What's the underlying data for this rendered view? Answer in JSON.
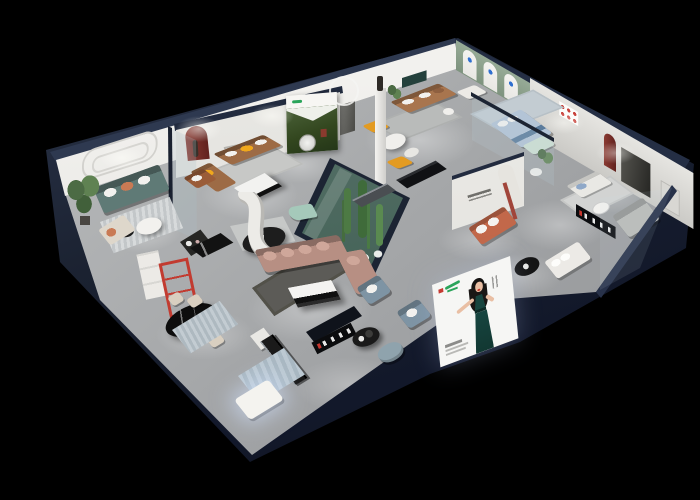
{
  "scene": {
    "type": "isometric-cutaway-floorplan-render",
    "description": "Isometric cutaway 3D rendering of a furniture showroom floor plan on a black background. Dark navy perimeter walls are cut open to reveal grey floors, white display walls, glass partitions, a glass-walled cactus garden, furnished room vignettes, spotlight pools and advertising light-boxes.",
    "canvas": {
      "width": 700,
      "height": 500
    },
    "background_color": "#000000",
    "lighting": "recessed spotlights casting warm white pools on floors and walls"
  },
  "palette": {
    "background": "#000000",
    "perimeter_wall_navy": "#1b2231",
    "perimeter_wall_dark": "#0d1019",
    "wall_cap_navy": "#2e3950",
    "interior_wall": "#e9e8e4",
    "wall_shadow": "#cfcecb",
    "floor": "#a3a5a7",
    "floor_light": "#c5c7c8",
    "sage_wall": "#8aa08e",
    "teal_sofa": "#5f7a76",
    "brown_leather": "#9d6b45",
    "caramel_leather": "#a8754e",
    "blush_sofa": "#b78f83",
    "mint_sofa": "#a5c9ba",
    "blue_bed": "#b3c4d6",
    "orange_accent": "#e39b22",
    "yellow_pillow": "#f0a81c",
    "terracotta_sofa": "#c2684a",
    "red_shelf": "#c23b30",
    "red_arch": "#7b2e29",
    "slate_blue_chair": "#7e94a4",
    "grey_sofa": "#b9bab7",
    "white_fabric": "#eceae6",
    "charcoal_rug": "#5c5b57",
    "blue_rug": "#b9c9d2",
    "cactus_green": "#4d7a44",
    "glass_tint": "#9ec4ad",
    "billboard_dress": "#17453f",
    "logo_green": "#2aa45a",
    "logo_red": "#c63a32",
    "skin_tone": "#e9bfa4"
  },
  "rooms": [
    {
      "id": "living-room-teal",
      "label": "Living room display - teal sofa",
      "key_items": [
        "teal three-seat sofa with white and terracotta pillows",
        "striped grey rug",
        "round white coffee table",
        "small black side table",
        "tall potted plant",
        "cream lounge chaise",
        "cognac leather armchair",
        "wall panel with stadium moulding",
        "glass partition"
      ]
    },
    {
      "id": "living-room-forest-poster",
      "label": "Living room display - brown leather sofa",
      "key_items": [
        "brown leather L-sofa with yellow pillows",
        "black and white coffee table",
        "grey rug",
        "forest wall poster",
        "dark-red arched niche with sculpture",
        "black sideboard cabinet"
      ]
    },
    {
      "id": "living-room-caramel",
      "label": "Living room display - caramel sofa",
      "key_items": [
        "caramel leather sofa",
        "two orange lounge chairs",
        "white nesting coffee tables",
        "white pedestal column with dark statue",
        "white ring mirror",
        "grey rug",
        "dark teal wall strip"
      ]
    },
    {
      "id": "bedroom-arched-wall",
      "label": "Bedroom display - sage arched wall",
      "key_items": [
        "sage wall with three white arched banners",
        "white armchair",
        "light-blue upholstered bed",
        "pale-green loveseat",
        "white side tables",
        "potted plant",
        "glass partition"
      ]
    },
    {
      "id": "right-wing-lounge",
      "label": "Right wing lounge and media wall",
      "key_items": [
        "white fabric sofa with blue pillow",
        "grey chaise sofa",
        "dark media panel",
        "dark-red arched niche",
        "grid of six small framed prints",
        "black sign strip",
        "white bed",
        "black round table"
      ]
    },
    {
      "id": "central-lounge",
      "label": "Central lounge display",
      "key_items": [
        "blush L-shaped sectional sofa",
        "white and black coffee table",
        "charcoal rug",
        "curved white partition",
        "mint-green loveseat",
        "black oval coffee table"
      ]
    },
    {
      "id": "indoor-garden",
      "label": "Glass cactus garden",
      "key_items": [
        "tall cacti",
        "white flowering shrubs",
        "green tinted glass enclosure with navy frame"
      ]
    },
    {
      "id": "dining-display",
      "label": "Dining display",
      "key_items": [
        "black oval marble dining table",
        "four cream chairs",
        "tall red open shelf",
        "white display cabinet",
        "black marble sideboard",
        "striped blue rug"
      ]
    },
    {
      "id": "kitchen-front-display",
      "label": "Front kitchen / island display",
      "key_items": [
        "long black island bench",
        "white bench",
        "glowing white chaise",
        "striped light-blue rug",
        "two slate-blue armchairs",
        "round black side table",
        "slate pouf",
        "black sign strip"
      ]
    },
    {
      "id": "terracotta-alcove",
      "label": "Terracotta sofa-bed alcove",
      "key_items": [
        "terracotta sofa-bed with white cushions",
        "white logo wall",
        "tall arched niche with red post"
      ]
    }
  ],
  "posters": {
    "forest_poster": {
      "location": "brown-leather living display wall",
      "content": "dark evergreen forest photo, white sky notch, white header band with green brand mark and round silver medallion",
      "text_legible": false
    },
    "arched_banners": {
      "location": "sage bedroom wall",
      "count": 3,
      "content": "white arched banner niches with small blue brand marks",
      "text_legible": false
    },
    "gallery_frames": {
      "location": "right wing wall",
      "count": 6,
      "content": "small white frames with red artwork",
      "text_legible": false
    },
    "logo_wall": {
      "location": "terracotta alcove",
      "content": "grey cursive brand signature",
      "text_legible": false
    }
  },
  "billboard": {
    "location": "leaning on front-right perimeter wall",
    "background": "#f6f6f4",
    "figure": "illustrated woman, long black hair, red lips, dark-teal evening gown, left arm extended, right hand on hip",
    "brand_mark_colors": [
      "#c63a32",
      "#2aa45a"
    ],
    "caption_lines": 3,
    "text_legible": false
  },
  "signage": [
    {
      "id": "sign-right-wing",
      "style": "black strip with white characters and red accent",
      "text_legible": false
    },
    {
      "id": "sign-front-center",
      "style": "black strip with white characters and red accent",
      "text_legible": false
    }
  ]
}
